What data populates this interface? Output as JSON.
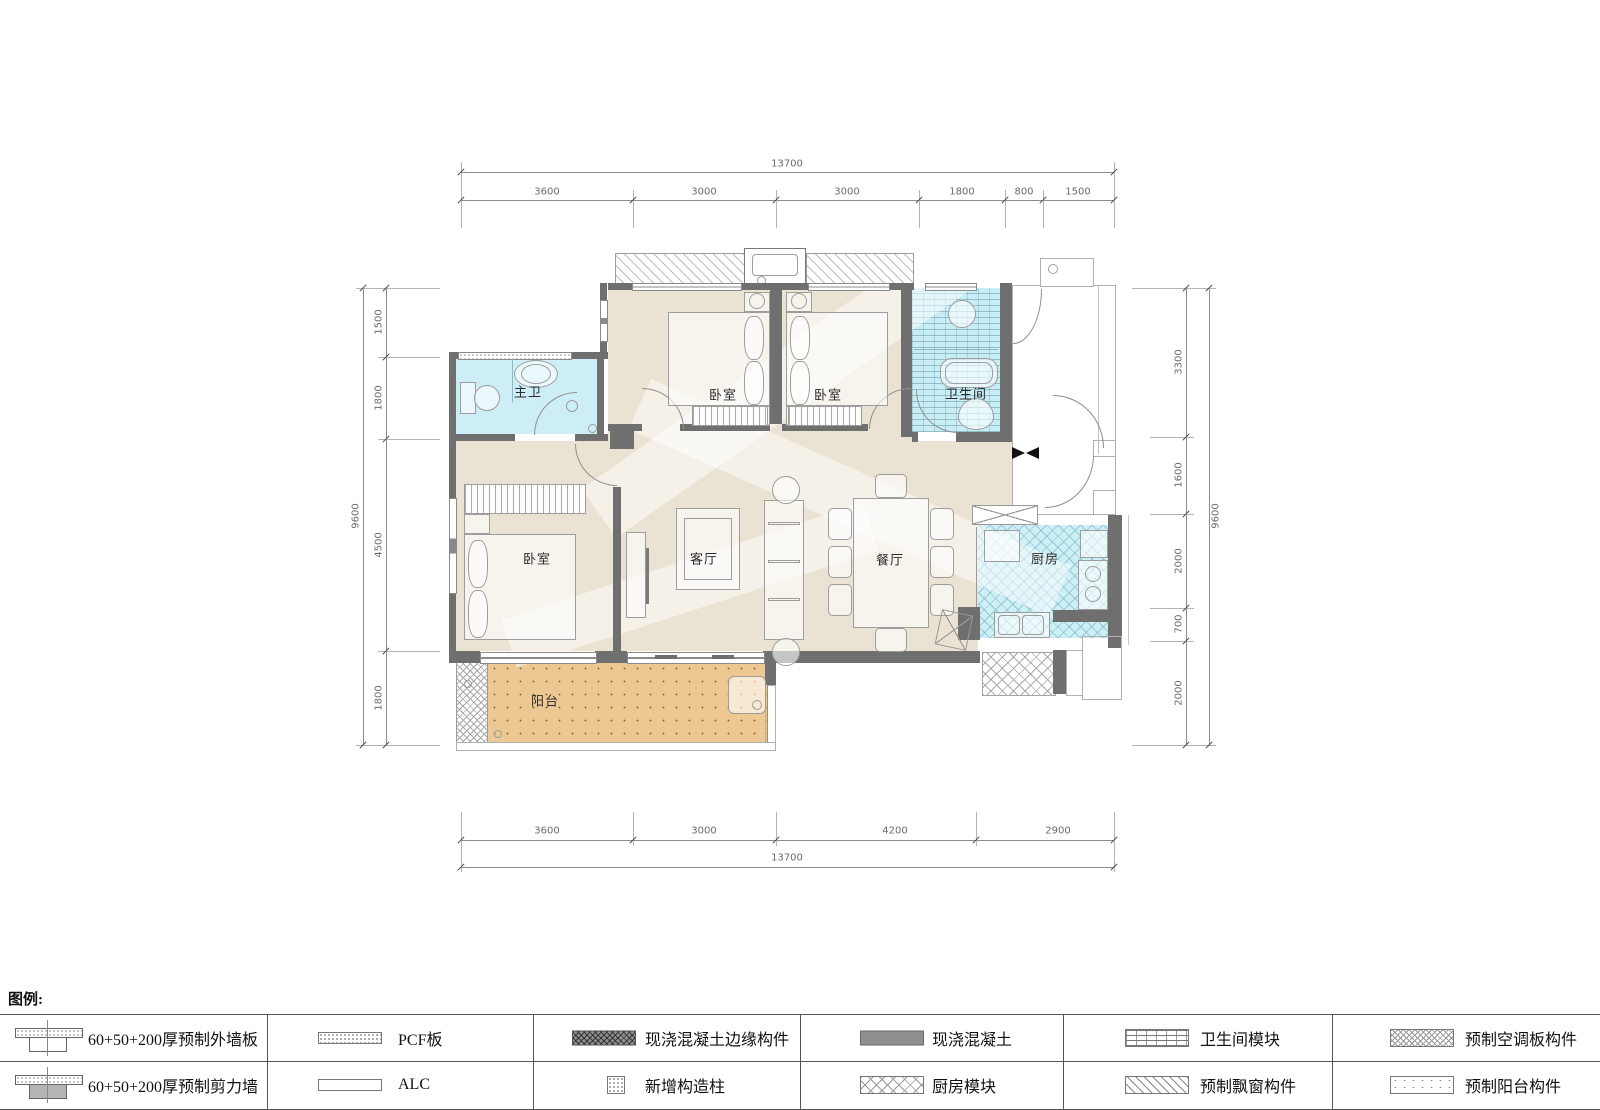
{
  "plan": {
    "room_labels": [
      {
        "name": "master-bath",
        "text": "主卫"
      },
      {
        "name": "bedroom-top-left",
        "text": "卧室"
      },
      {
        "name": "bedroom-top-right",
        "text": "卧室"
      },
      {
        "name": "bathroom",
        "text": "卫生间"
      },
      {
        "name": "bedroom-bottom-left",
        "text": "卧室"
      },
      {
        "name": "living-room",
        "text": "客厅"
      },
      {
        "name": "dining-room",
        "text": "餐厅"
      },
      {
        "name": "kitchen",
        "text": "厨房"
      },
      {
        "name": "balcony",
        "text": "阳台"
      }
    ]
  },
  "dimensions": {
    "top": {
      "total": "13700",
      "segments": [
        "3600",
        "3000",
        "3000",
        "1800",
        "800",
        "1500"
      ]
    },
    "bottom": {
      "total": "13700",
      "segments": [
        "3600",
        "3000",
        "4200",
        "2900"
      ]
    },
    "left": {
      "total": "9600",
      "segments": [
        "1500",
        "1800",
        "4500",
        "1800"
      ]
    },
    "right": {
      "total": "9600",
      "segments": [
        "3300",
        "1600",
        "2000",
        "700",
        "2000"
      ]
    }
  },
  "legend": {
    "title": "图例:",
    "items": [
      {
        "label": "60+50+200厚预制外墙板",
        "symbol": "precast-exterior-wall-panel"
      },
      {
        "label": "60+50+200厚预制剪力墙",
        "symbol": "precast-shear-wall"
      },
      {
        "label": "PCF板",
        "symbol": "pcf-board"
      },
      {
        "label": "ALC",
        "symbol": "alc-board"
      },
      {
        "label": "现浇混凝土边缘构件",
        "symbol": "cast-in-place-concrete-edge"
      },
      {
        "label": "新增构造柱",
        "symbol": "new-structural-column"
      },
      {
        "label": "现浇混凝土",
        "symbol": "cast-in-place-concrete"
      },
      {
        "label": "厨房模块",
        "symbol": "kitchen-module"
      },
      {
        "label": "卫生间模块",
        "symbol": "bathroom-module"
      },
      {
        "label": "预制飘窗构件",
        "symbol": "precast-bay-window"
      },
      {
        "label": "预制空调板构件",
        "symbol": "precast-ac-board"
      },
      {
        "label": "预制阳台构件",
        "symbol": "precast-balcony"
      }
    ]
  },
  "colors": {
    "floor": "#eae2d2",
    "wet_area": "#cdeef6",
    "balcony": "#edc892",
    "wall": "#6f6f6f"
  }
}
